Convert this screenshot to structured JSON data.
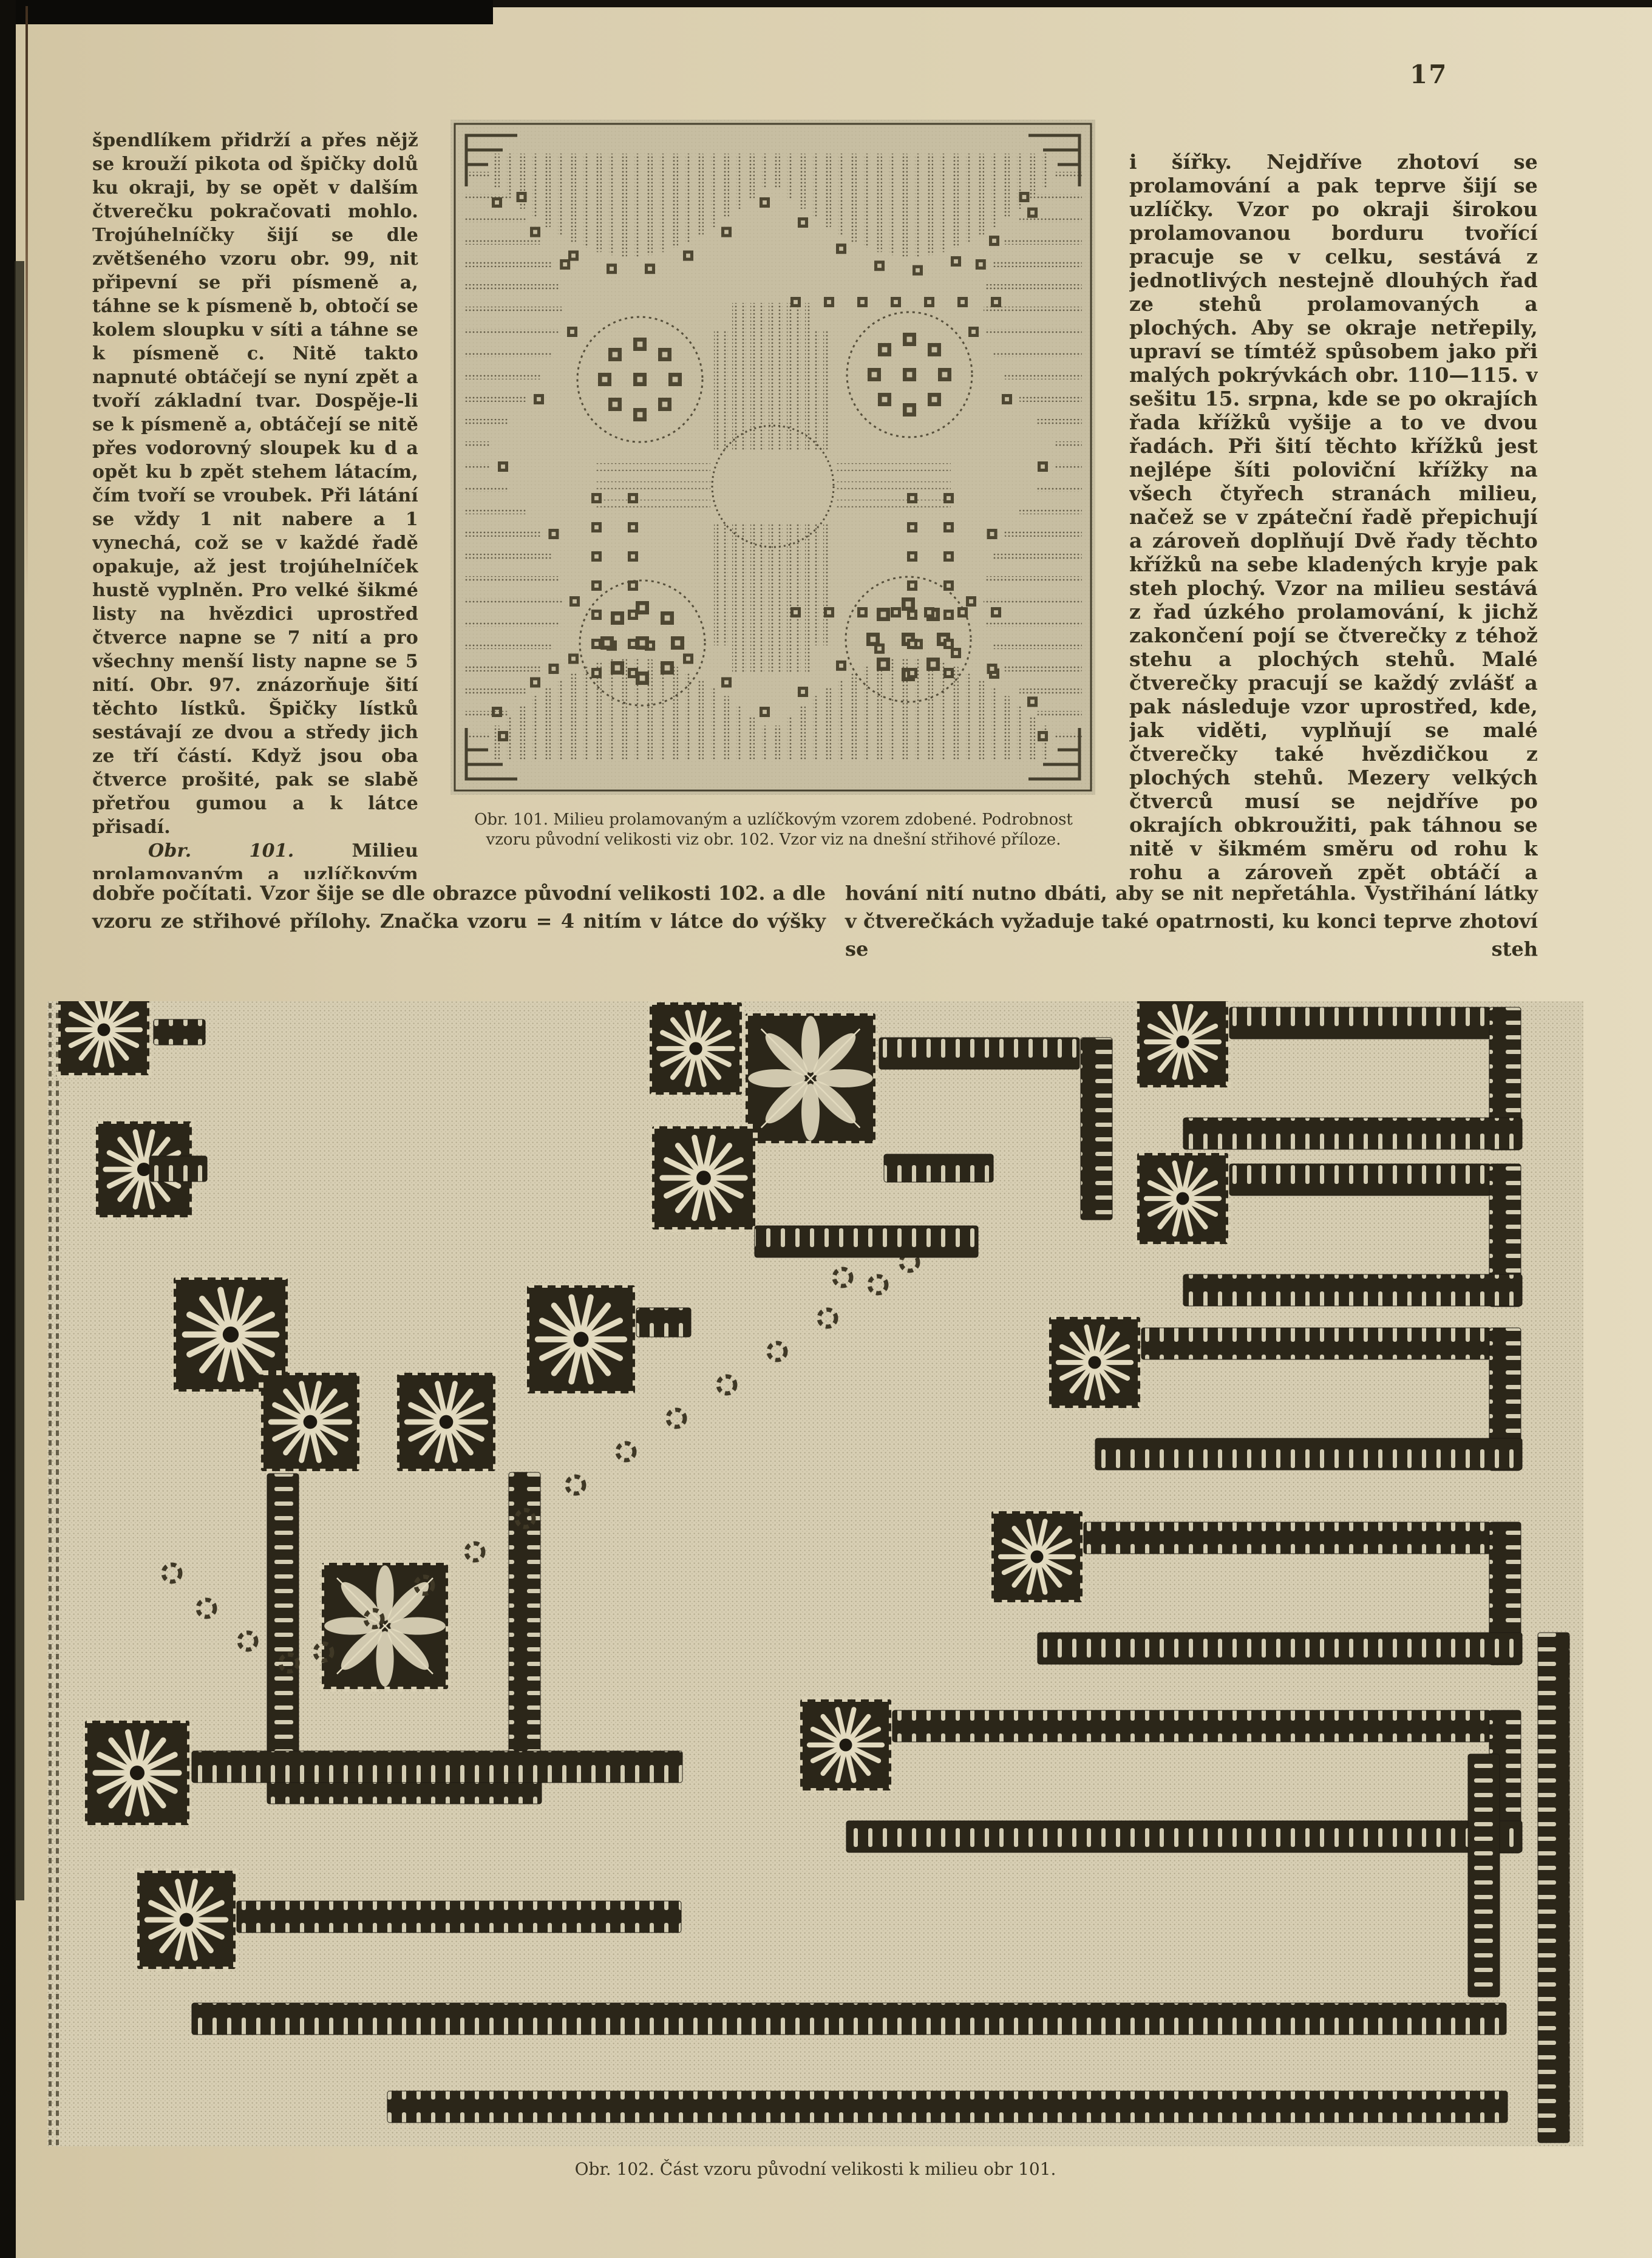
{
  "page": {
    "number": "17"
  },
  "colors": {
    "paper": "#d9cdae",
    "ink": "#37311f",
    "fig_bg": "#c7bea2",
    "fig_ink": "#554e3a",
    "fabric": "#d7ceb3",
    "stitch_dark": "#2b2619",
    "stitch_light": "#e2dabf"
  },
  "columns": {
    "left": {
      "para1": "špendlíkem přidrží a přes nějž se krouží pikota od špičky dolů ku okraji, by se opět v dalším čtverečku pokračovati mohlo. Trojúhelníčky šijí se dle zvětšeného vzoru obr. 99, nit připevní se při písmeně a, táhne se k písmeně b, obtočí se kolem sloupku v síti a táhne se k písmeně c. Nitě takto napnuté obtáčejí se nyní zpět a tvoří základní tvar. Dospěje-li se k písmeně a, obtáčejí se nitě přes vodorovný sloupek ku d a opět ku b zpět stehem látacím, čím tvoří se vroubek. Při látání se vždy 1 nit nabere a 1 vynechá, což se v každé řadě opakuje, až jest trojúhelníček hustě vyplněn. Pro velké šikmé listy na hvězdici uprostřed čtverce napne se 7 nití a pro všechny menší listy napne se 5 nití. Obr. 97. znázorňuje šití těchto lístků. Špičky lístků sestávají ze dvou a středy jich ze tří částí. Když jsou oba čtverce prošité, pak se slabě přetřou gumou a k látce přisadí.",
      "para2_lead": "Obr. 101.",
      "para2_rest": " Milieu prolamovaným a uzlíčkovým stehem vyšité má býti 66 cm. dlouhé a stejně široké; zhotoví se z bílého 75 cm. dlouhého a stejně širokého kusu plátna, na němž možno nitě"
    },
    "left_wide": "dobře počítati. Vzor šije se dle obrazce původní velikosti 102. a dle vzoru ze střihové přílohy. Značka vzoru = 4 nitím v látce do výšky",
    "right": {
      "para1": "i šířky. Nejdříve zhotoví se prolamování a pak teprve šijí se uzlíčky. Vzor po okraji širokou prolamovanou borduru tvořící pracuje se v celku, sestává z jednotlivých nestejně dlouhých řad ze stehů prolamovaných a plochých. Aby se okraje netřepily, upraví se tímtéž spůsobem jako při malých pokrývkách obr. 110—115. v sešitu 15. srpna, kde se po okrajích řada křížků vyšije a to ve dvou řadách. Při šití těchto křížků jest nejlépe šíti poloviční křížky na všech čtyřech stranách milieu, načež se v zpáteční řadě přepichují a zároveň doplňují Dvě řady těchto křížků na sebe kladených kryje pak steh plochý. Vzor na milieu sestává z řad úzkého prolamování, k jichž zakončení pojí se čtverečky z téhož stehu a plochých stehů. Malé čtverečky pracují se každý zvlášť a pak následuje vzor uprostřed, kde, jak viděti, vyplňují se malé čtverečky také hvězdičkou z plochých stehů. Mezery velkých čtverců musí se nejdříve po okrajích obkroužiti, pak táhnou se nitě v šikmém směru od rohu k rohu a zároveň zpět obtáčí a současně vyplní se hustými trojúhelníčky. Při vyta-"
    },
    "right_wide": "hování nití nutno dbáti, aby se nit nepřetáhla. Vystřihání látky v čtverečkách vyžaduje také opatrnosti, ku konci teprve zhotoví se steh"
  },
  "figures": {
    "fig101": {
      "caption": "Obr. 101. Milieu prolamovaným a uzlíčkovým vzorem zdobené. Podrobnost vzoru původní velikosti viz obr. 102. Vzor viz na dnešní střihové příloze."
    },
    "fig102": {
      "caption": "Obr. 102. Část vzoru původní velikosti k milieu obr 101."
    }
  }
}
